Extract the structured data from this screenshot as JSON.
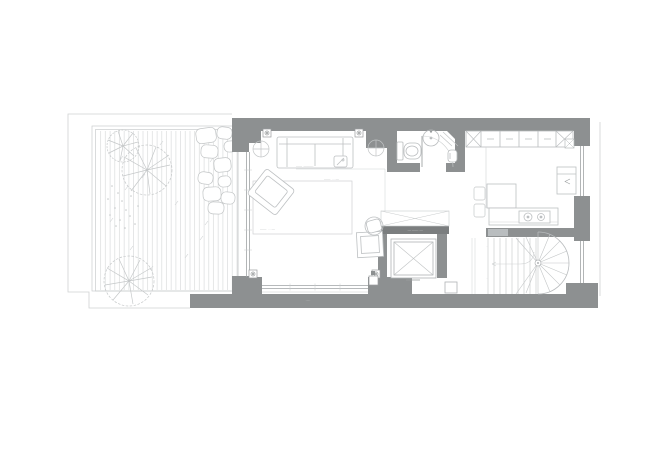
{
  "figure": {
    "description": "Black-and-white architectural floor plan: left terrace with wood decking, two round trees and boulder seating; centre living room with sofa, two round side tables, armchair, rug and desk; top-right bathroom with toilet, round basin, swing door and corner shower; right kitchen with wall cabinets, peninsula table with two chairs, cooktop counter and sink; central elevator shaft with X symbol and skylight void; bottom-right winder/spiral staircase; grey walls with window openings on south and east facades."
  },
  "colors": {
    "background": "#ffffff",
    "wall": "#8d9091",
    "wall_dark": "#7b7e7f",
    "threshold": "#b9bdbf",
    "furniture_line": "#bdc0c2",
    "light_line": "#ced1d2",
    "deck_line": "#dadcdd",
    "glass_line": "#9fa3a5",
    "annotation_text": "#a7abad"
  },
  "annotations": {
    "sofa_label": "—— ·———·",
    "rug_label_top": "——· ····—",
    "rug_label_bottom": "——· ····—",
    "elevator_bar_label": "·— ——··—",
    "south_window_label": "·—·",
    "stair_mark_upper": "··",
    "stair_mark_lower": "··"
  }
}
